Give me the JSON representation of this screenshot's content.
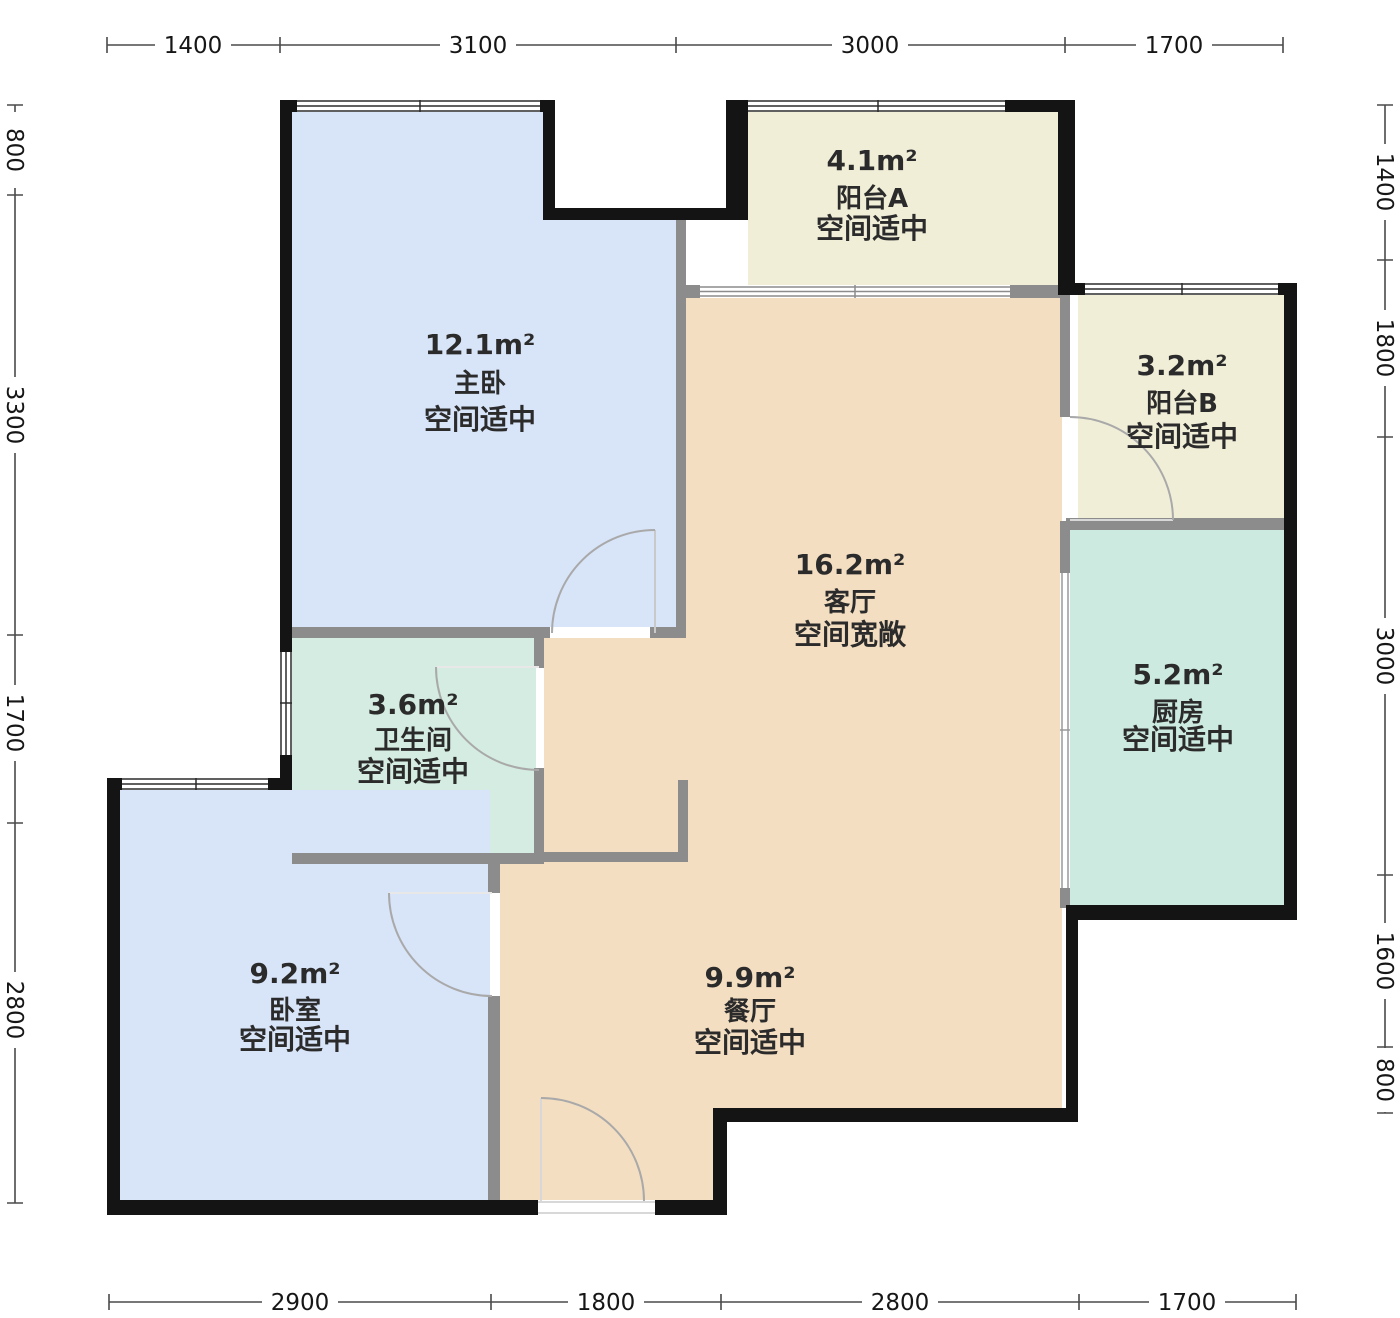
{
  "plan": {
    "unit_system": "floorplan-dimensions",
    "wall_color": "#141414",
    "inner_wall_color": "#8c8c8c",
    "dim_line_color": "#4a4a4a"
  },
  "dimensions": {
    "top": [
      "1400",
      "3100",
      "3000",
      "1700"
    ],
    "bottom": [
      "2900",
      "1800",
      "2800",
      "1700"
    ],
    "left": [
      "800",
      "3300",
      "1700",
      "2800"
    ],
    "right": [
      "1400",
      "1800",
      "3000",
      "1600",
      "800"
    ]
  },
  "rooms": [
    {
      "id": "master-bedroom",
      "area": "12.1m²",
      "name": "主卧",
      "note": "空间适中",
      "color": "#d8e4f8"
    },
    {
      "id": "balcony-a",
      "area": "4.1m²",
      "name": "阳台A",
      "note": "空间适中",
      "color": "#f1eed8"
    },
    {
      "id": "balcony-b",
      "area": "3.2m²",
      "name": "阳台B",
      "note": "空间适中",
      "color": "#f1eed8"
    },
    {
      "id": "living-room",
      "area": "16.2m²",
      "name": "客厅",
      "note": "空间宽敞",
      "color": "#f3dec2"
    },
    {
      "id": "kitchen",
      "area": "5.2m²",
      "name": "厨房",
      "note": "空间适中",
      "color": "#cceae0"
    },
    {
      "id": "bathroom",
      "area": "3.6m²",
      "name": "卫生间",
      "note": "空间适中",
      "color": "#d4ece1"
    },
    {
      "id": "bedroom",
      "area": "9.2m²",
      "name": "卧室",
      "note": "空间适中",
      "color": "#d8e4f8"
    },
    {
      "id": "dining-room",
      "area": "9.9m²",
      "name": "餐厅",
      "note": "空间适中",
      "color": "#f3dec2"
    }
  ]
}
